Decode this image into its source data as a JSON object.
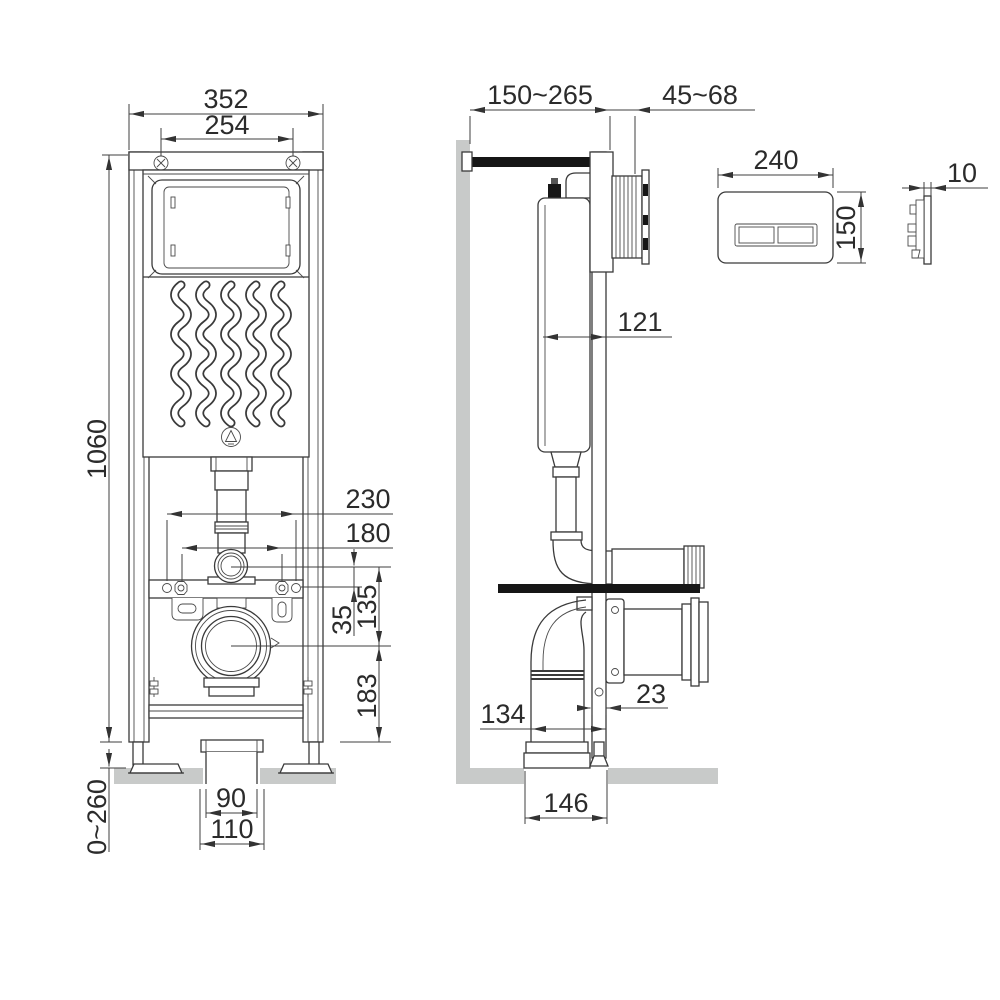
{
  "colors": {
    "line": "#3a3a3a",
    "surface_gray": "#c8cac9",
    "accent_black": "#161616",
    "background": "#ffffff"
  },
  "dimensions": {
    "front": {
      "frame_width": "352",
      "top_fixing_spacing": "254",
      "frame_height": "1060",
      "leg_adjustment": "0~260",
      "fixing_spacing_outer": "230",
      "fixing_spacing_inner": "180",
      "flush_to_fixings": "35",
      "flush_to_outlet": "135",
      "outlet_to_floor": "183",
      "outlet_pipe_inner": "90",
      "outlet_pipe_outer": "110"
    },
    "side": {
      "wall_offset": "150~265",
      "actuator_depth": "45~68",
      "cistern_depth": "121",
      "frame_profile_depth": "23",
      "outlet_offset": "134",
      "floor_opening": "146"
    },
    "plate": {
      "width": "240",
      "height": "150",
      "thickness": "10"
    }
  }
}
